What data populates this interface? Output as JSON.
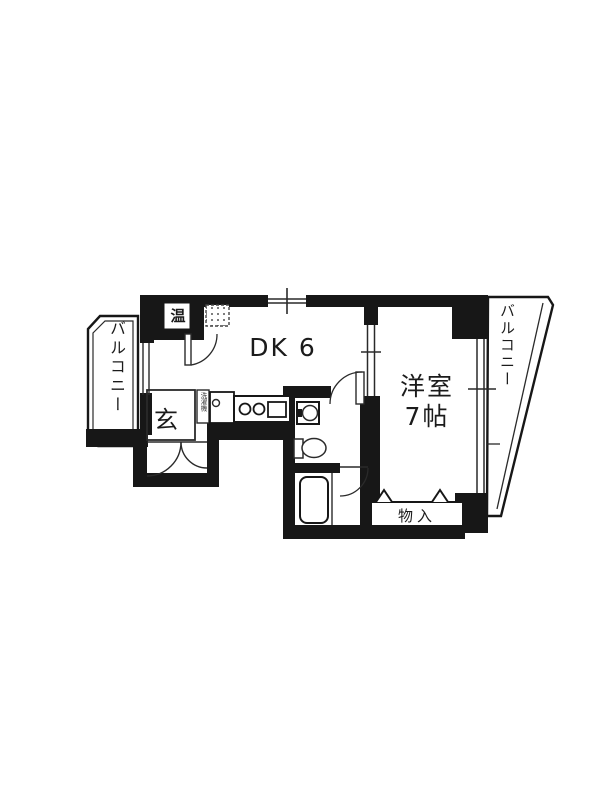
{
  "floorplan": {
    "labels": {
      "dk": "DK 6",
      "western_room_line1": "洋室",
      "western_room_line2": "7帖",
      "entrance": "玄",
      "storage": "物入",
      "balcony_left": "バルコニー",
      "balcony_right": "バルコニー",
      "water_heater": "温",
      "washing_machine": "洗濯機"
    },
    "colors": {
      "wall": "#171717",
      "line": "#2a2a2a",
      "background": "#ffffff"
    }
  }
}
